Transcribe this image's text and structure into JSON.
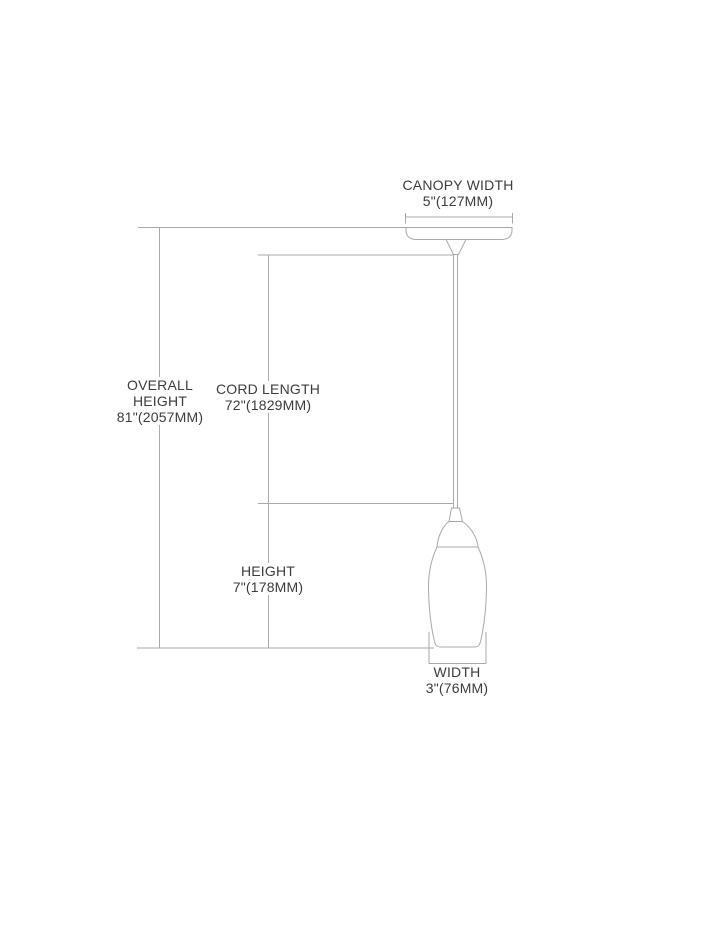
{
  "colors": {
    "background": "#ffffff",
    "line": "#a9a9a9",
    "text": "#3c3c3c"
  },
  "labels": {
    "canopy_width": {
      "line1": "CANOPY WIDTH",
      "line2": "5\"(127MM)"
    },
    "overall_height": {
      "line1": "OVERALL",
      "line2": "HEIGHT",
      "line3": "81\"(2057MM)"
    },
    "cord_length": {
      "line1": "CORD LENGTH",
      "line2": "72\"(1829MM)"
    },
    "height": {
      "line1": "HEIGHT",
      "line2": "7\"(178MM)"
    },
    "width": {
      "line1": "WIDTH",
      "line2": "3\"(76MM)"
    }
  }
}
